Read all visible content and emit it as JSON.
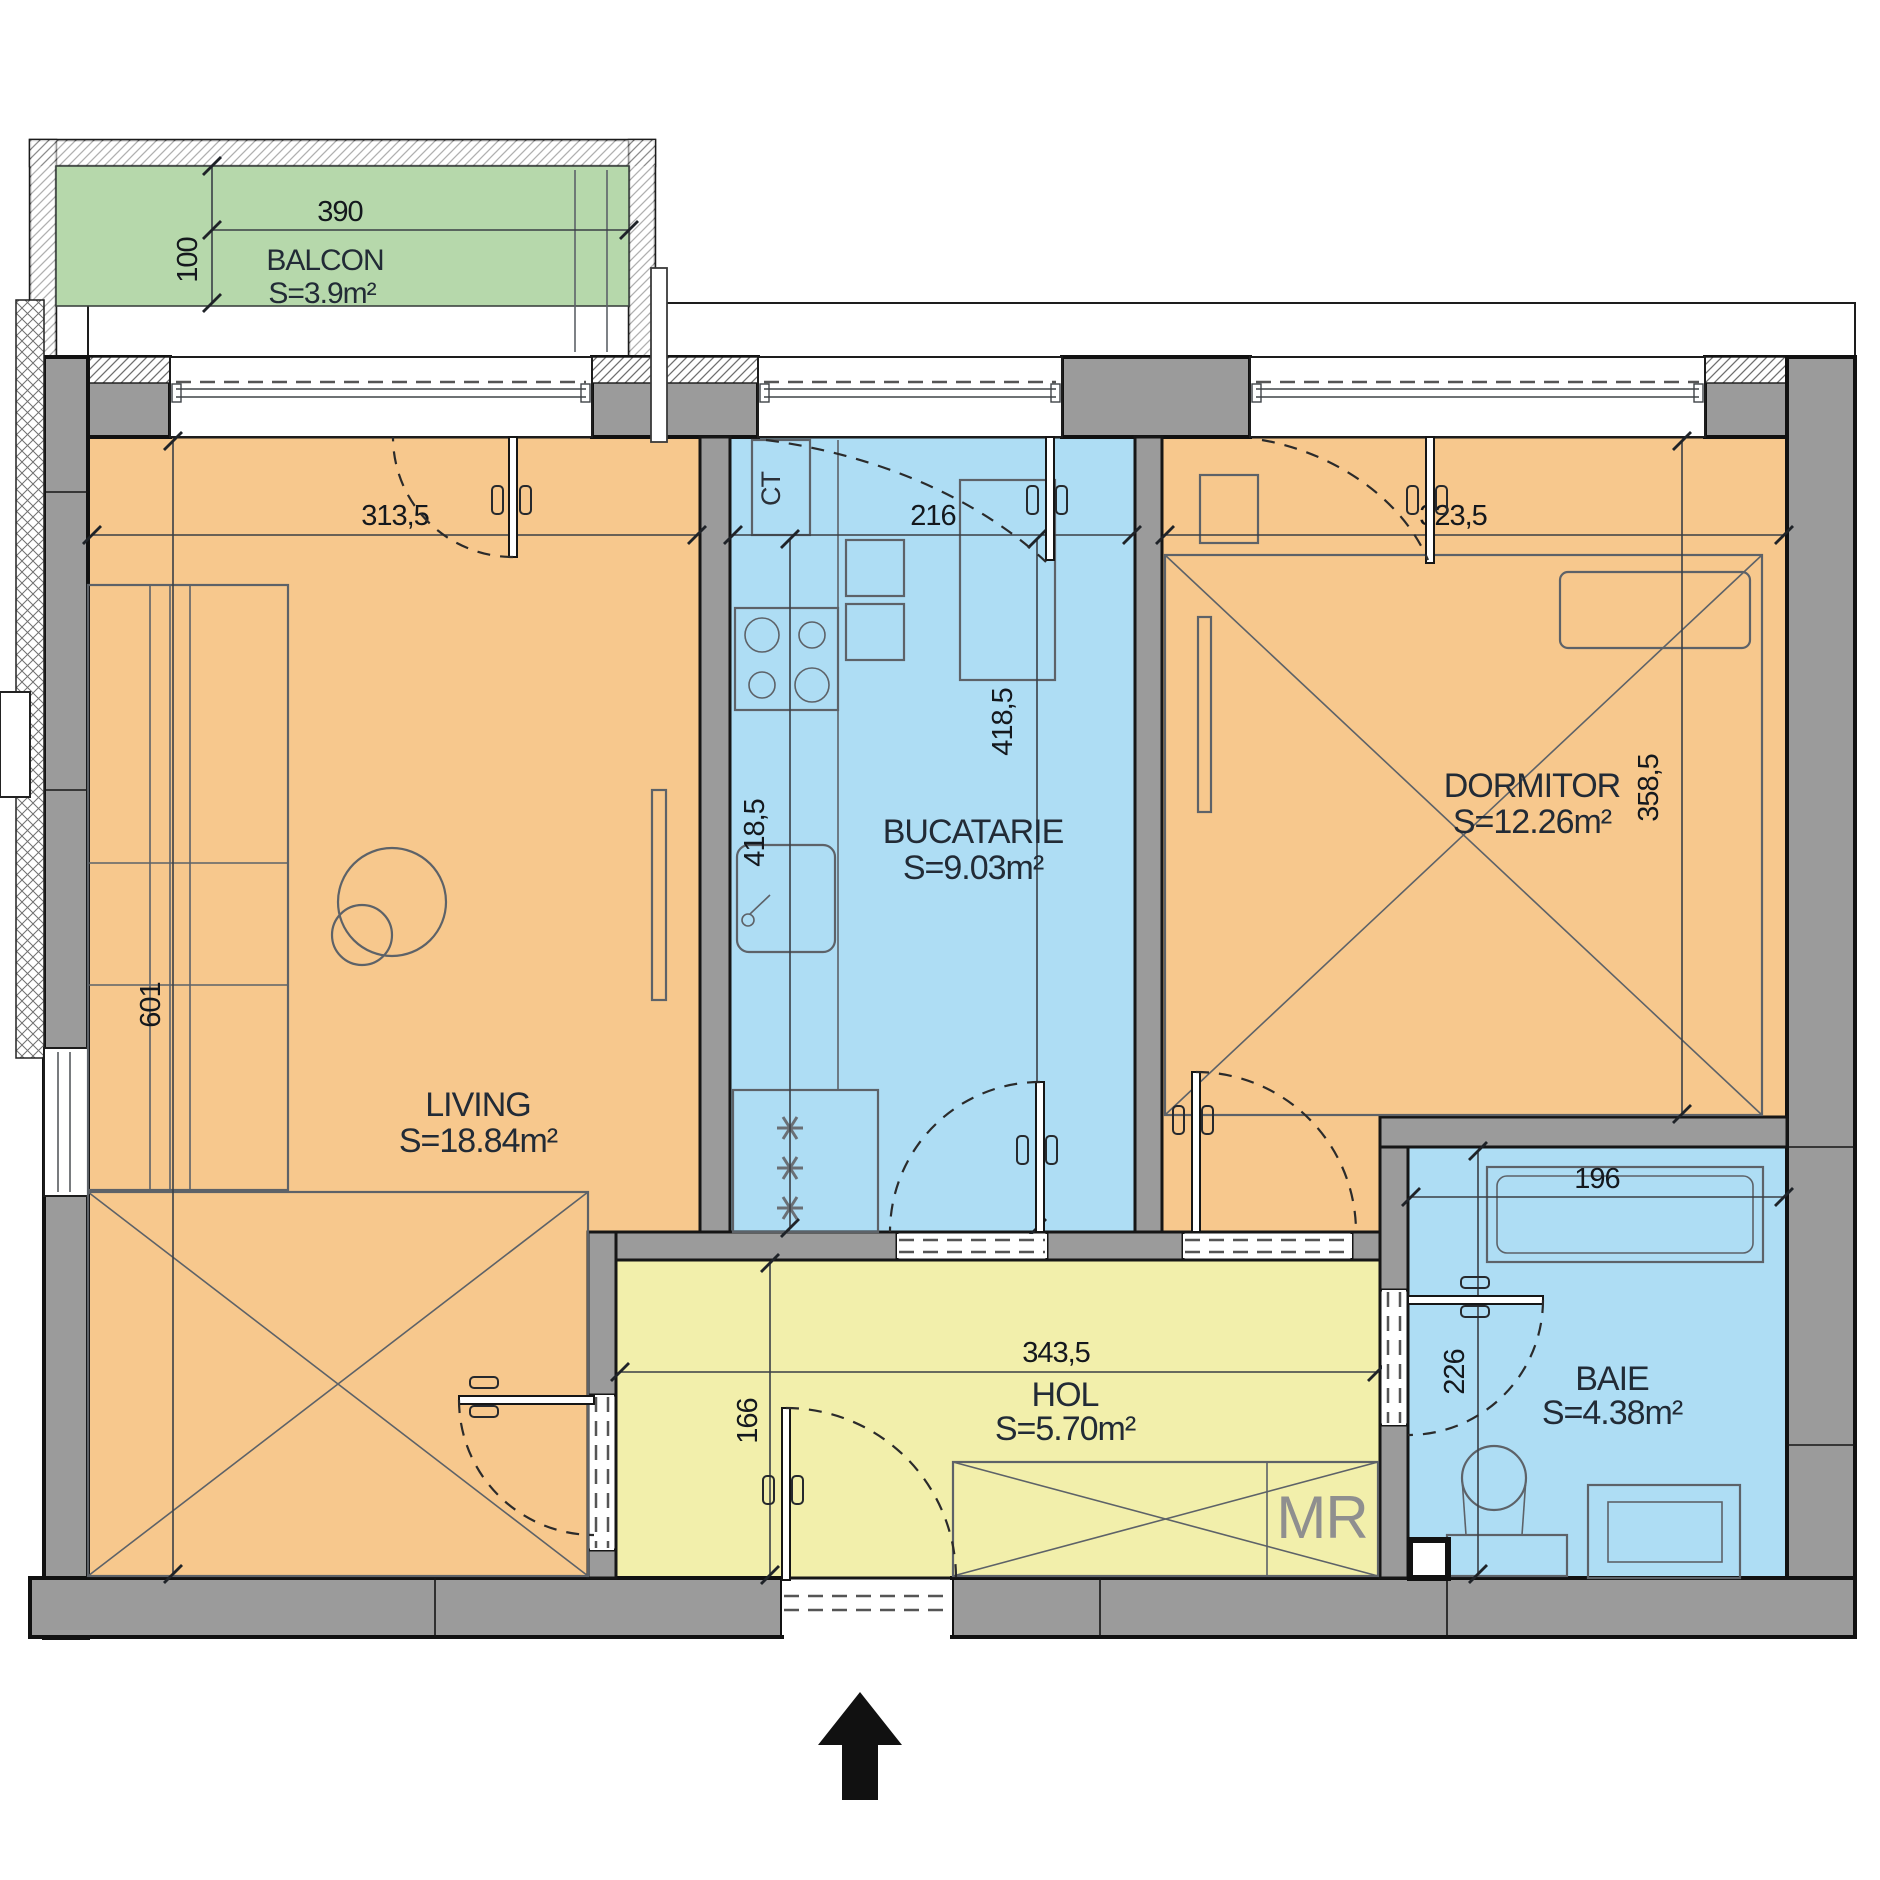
{
  "plan": {
    "rooms": [
      {
        "name": "BALCON",
        "area": "S=3.9m²"
      },
      {
        "name": "LIVING",
        "area": "S=18.84m²"
      },
      {
        "name": "BUCATARIE",
        "area": "S=9.03m²"
      },
      {
        "name": "DORMITOR",
        "area": "S=12.26m²"
      },
      {
        "name": "HOL",
        "area": "S=5.70m²"
      },
      {
        "name": "BAIE",
        "area": "S=4.38m²"
      }
    ],
    "dimensions": {
      "balcony_width": "390",
      "balcony_depth": "100",
      "living_width": "313,5",
      "living_depth": "601",
      "kitchen_width": "216",
      "kitchen_depth_left": "418,5",
      "kitchen_depth_right": "418,5",
      "bedroom_width": "323,5",
      "bedroom_depth": "358,5",
      "hall_width": "343,5",
      "hall_depth": "166",
      "bathroom_width": "196",
      "bathroom_depth": "226"
    },
    "equipment": {
      "boiler": "CT",
      "washing_machine": "MR"
    },
    "colors": {
      "living": "#f7c88d",
      "bedroom": "#f7c88d",
      "kitchen": "#aeddf4",
      "bathroom": "#aeddf4",
      "hall": "#f2efab",
      "balcony": "#b6d8ab",
      "wall": "#9b9b9b"
    }
  }
}
